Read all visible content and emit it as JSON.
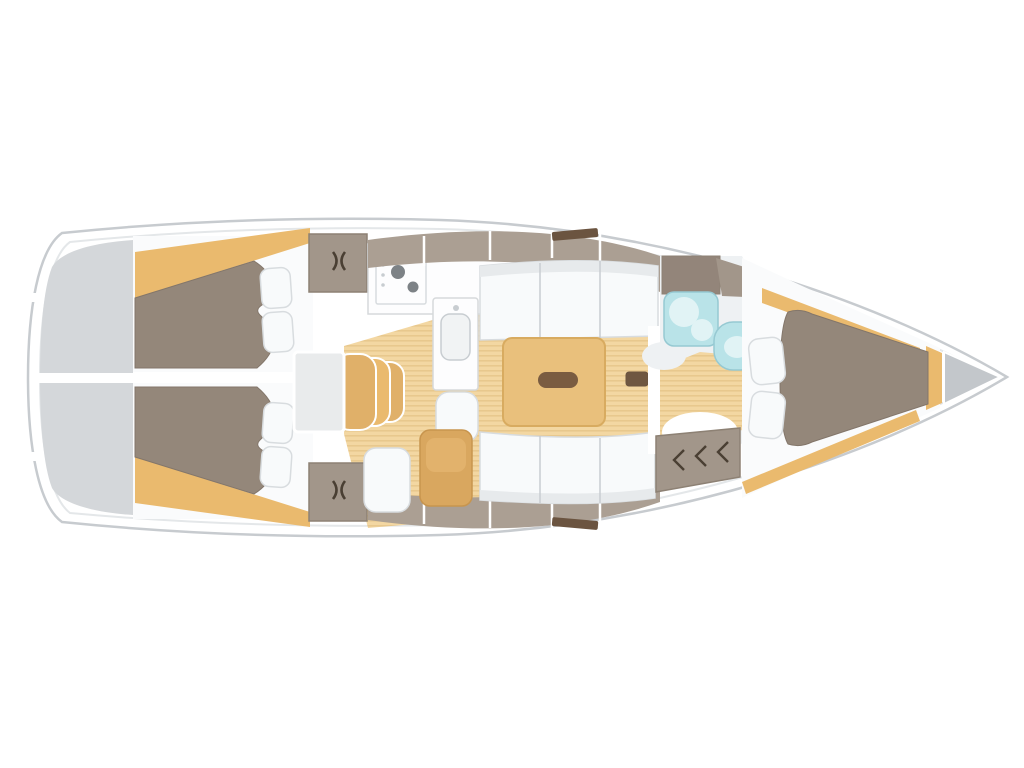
{
  "diagram": {
    "type": "boat-floor-plan",
    "subject": "sailing-yacht-interior-layout-top-view",
    "orientation": {
      "stern": "left",
      "bow": "right"
    },
    "regions": [
      {
        "name": "transom-platform"
      },
      {
        "name": "aft-cabin-starboard",
        "features": [
          "double-berth",
          "two-pillows",
          "shelf-trim"
        ]
      },
      {
        "name": "aft-cabin-port",
        "features": [
          "double-berth",
          "two-pillows",
          "shelf-trim"
        ]
      },
      {
        "name": "wardrobe-starboard"
      },
      {
        "name": "wardrobe-port"
      },
      {
        "name": "companionway",
        "features": [
          "landing",
          "three-steps"
        ]
      },
      {
        "name": "galley",
        "features": [
          "stove",
          "sink-counter"
        ]
      },
      {
        "name": "saloon",
        "features": [
          "settee-starboard",
          "settee-port",
          "dining-table",
          "mast-step"
        ]
      },
      {
        "name": "nav-area",
        "features": [
          "seat-cushion",
          "tan-chair"
        ]
      },
      {
        "name": "head-bathroom",
        "features": [
          "washbasin",
          "toilet",
          "shower-floor",
          "top-locker"
        ]
      },
      {
        "name": "louvered-locker"
      },
      {
        "name": "v-berth-cabin",
        "features": [
          "double-berth",
          "two-pillows",
          "shelf-trim"
        ]
      },
      {
        "name": "anchor-locker"
      }
    ],
    "icons": [
      {
        "name": "latch-icon",
        "shape": "paired curved hooks"
      },
      {
        "name": "louver-latch-icon",
        "shape": "double chevron"
      }
    ],
    "colors": {
      "page_bg": "#ffffff",
      "hull_fill": "#ffffff",
      "hull_stroke": "#c7cbcf",
      "hull_inner_line": "#e4e7e9",
      "transom_gray": "#d4d7da",
      "cabin_floor_white": "#fafbfc",
      "berth_taupe": "#94877a",
      "berth_edge": "#83766a",
      "tan_trim": "#eaba6e",
      "tan_step": "#e0b069",
      "floor_tan": "#f3d7a2",
      "floor_stripe": "#e8c88d",
      "table_tan": "#e9c07c",
      "table_edge": "#d8ab60",
      "dark_handle": "#7a5c41",
      "mast_dark": "#6f5741",
      "cushion_white": "#f8fafb",
      "cushion_stroke": "#d8dcdf",
      "seam_gray": "#c8cdd1",
      "backrest_gray": "#e7eaec",
      "locker_taupe": "#a2968a",
      "locker_taupe_light": "#ab9f93",
      "locker_taupe_dark": "#93857a",
      "locker_stroke": "#8d8174",
      "hatch_dark": "#6b5440",
      "counter_white": "#fdfdfe",
      "counter_stroke": "#d6d9db",
      "sink_inner": "#f1f3f4",
      "stove_burner": "#7d8286",
      "cyan_fixture": "#b9e3e8",
      "cyan_light": "#e1f3f5",
      "cyan_stroke": "#96c9d2",
      "head_floor": "#eef1f3",
      "anchor_gray": "#c3c7cb",
      "chair_tan": "#d9a75f",
      "chair_tan_light": "#e2b26c",
      "chair_stroke": "#c8954e",
      "latch_dark": "#4a3f33",
      "landing_gray": "#e9ebec"
    }
  }
}
